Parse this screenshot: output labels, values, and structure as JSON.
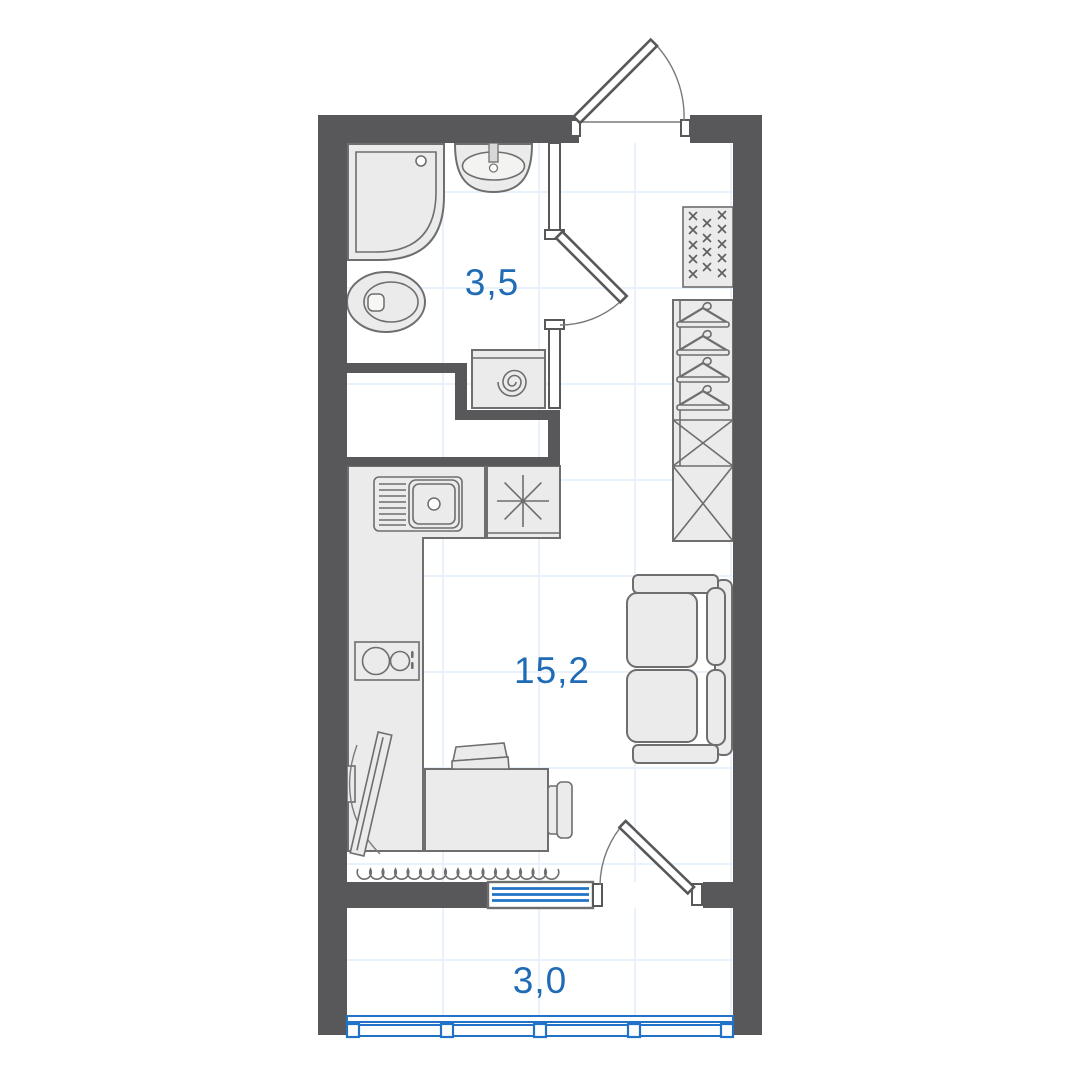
{
  "title": "Studio apartment floor plan",
  "rooms": [
    {
      "name": "bathroom",
      "area_label": "3,5"
    },
    {
      "name": "living-kitchen",
      "area_label": "15,2"
    },
    {
      "name": "balcony",
      "area_label": "3,0"
    }
  ],
  "fixtures": [
    "entrance-door",
    "shower",
    "bathroom-sink",
    "toilet",
    "washing-machine",
    "bathroom-door",
    "shelving-unit",
    "wardrobe-with-hangers",
    "wardrobe-boxes",
    "kitchen-counter",
    "kitchen-sink",
    "stove",
    "cooktop",
    "tv",
    "desk",
    "desk-chair",
    "side-chair",
    "sofa",
    "radiator-coil",
    "balcony-window",
    "balcony-door",
    "balcony-glazing"
  ],
  "colors": {
    "background": "#ffffff",
    "wall": "#58585a",
    "furniture_fill": "#ebebec",
    "furniture_stroke": "#6e6e6e",
    "label_blue": "#1f6bb5",
    "window_blue": "#2273c8",
    "grid_blue": "#e9f2fc"
  }
}
